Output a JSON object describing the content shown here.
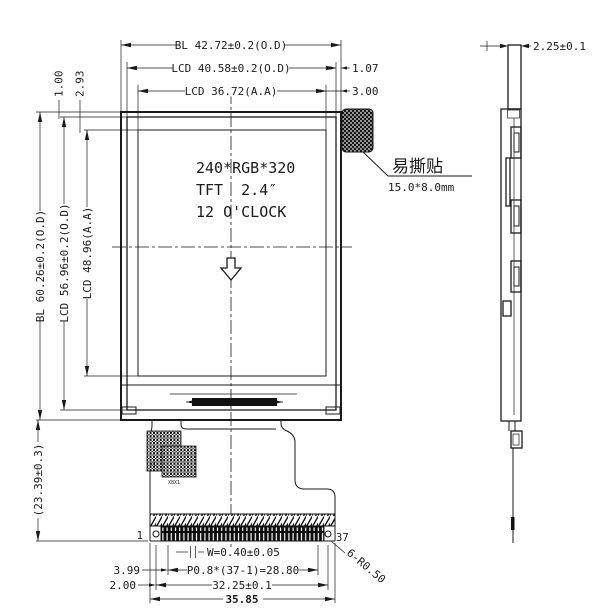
{
  "drawing": {
    "title_note": "LCD module outline drawing",
    "top_dims": {
      "bl_width": "BL 42.72±0.2(O.D)",
      "lcd_width": "LCD 40.58±0.2(O.D)",
      "aa_width": "LCD 36.72(A.A)",
      "edge_to_lcd": "1.07",
      "edge_to_aa": "3.00"
    },
    "left_dims": {
      "gap_bl_lcd": "1.00",
      "gap_lcd_aa": "2.93",
      "bl_height": "BL 60.26±0.2(O.D)",
      "lcd_height": "LCD 56.96±0.2(O.D)",
      "aa_height": "LCD 48.96(A.A)",
      "fpc_length": "(23.39±0.3)"
    },
    "panel_text": {
      "line1": "240*RGB*320",
      "line2": "TFT  2.4″",
      "line3": "12 O'CLOCK"
    },
    "sticker": {
      "label": "易撕贴",
      "size": "15.0*8.0mm"
    },
    "side_view": {
      "thickness": "2.25±0.1"
    },
    "fpc": {
      "pin_first": "1",
      "pin_last": "37",
      "pin_width": "W=0.40±0.05",
      "pitch": "P0.8*(37-1)=28.80",
      "edge_to_pin1": "3.99",
      "edge_to_hole": "2.00",
      "hole_span": "32.25±0.1",
      "total_width": "35.85",
      "corner_radius": "6-R0.50",
      "comp1": "X1",
      "comp2": "X8X1"
    },
    "colors": {
      "line": "#1a1a1a",
      "background": "#ffffff"
    }
  }
}
